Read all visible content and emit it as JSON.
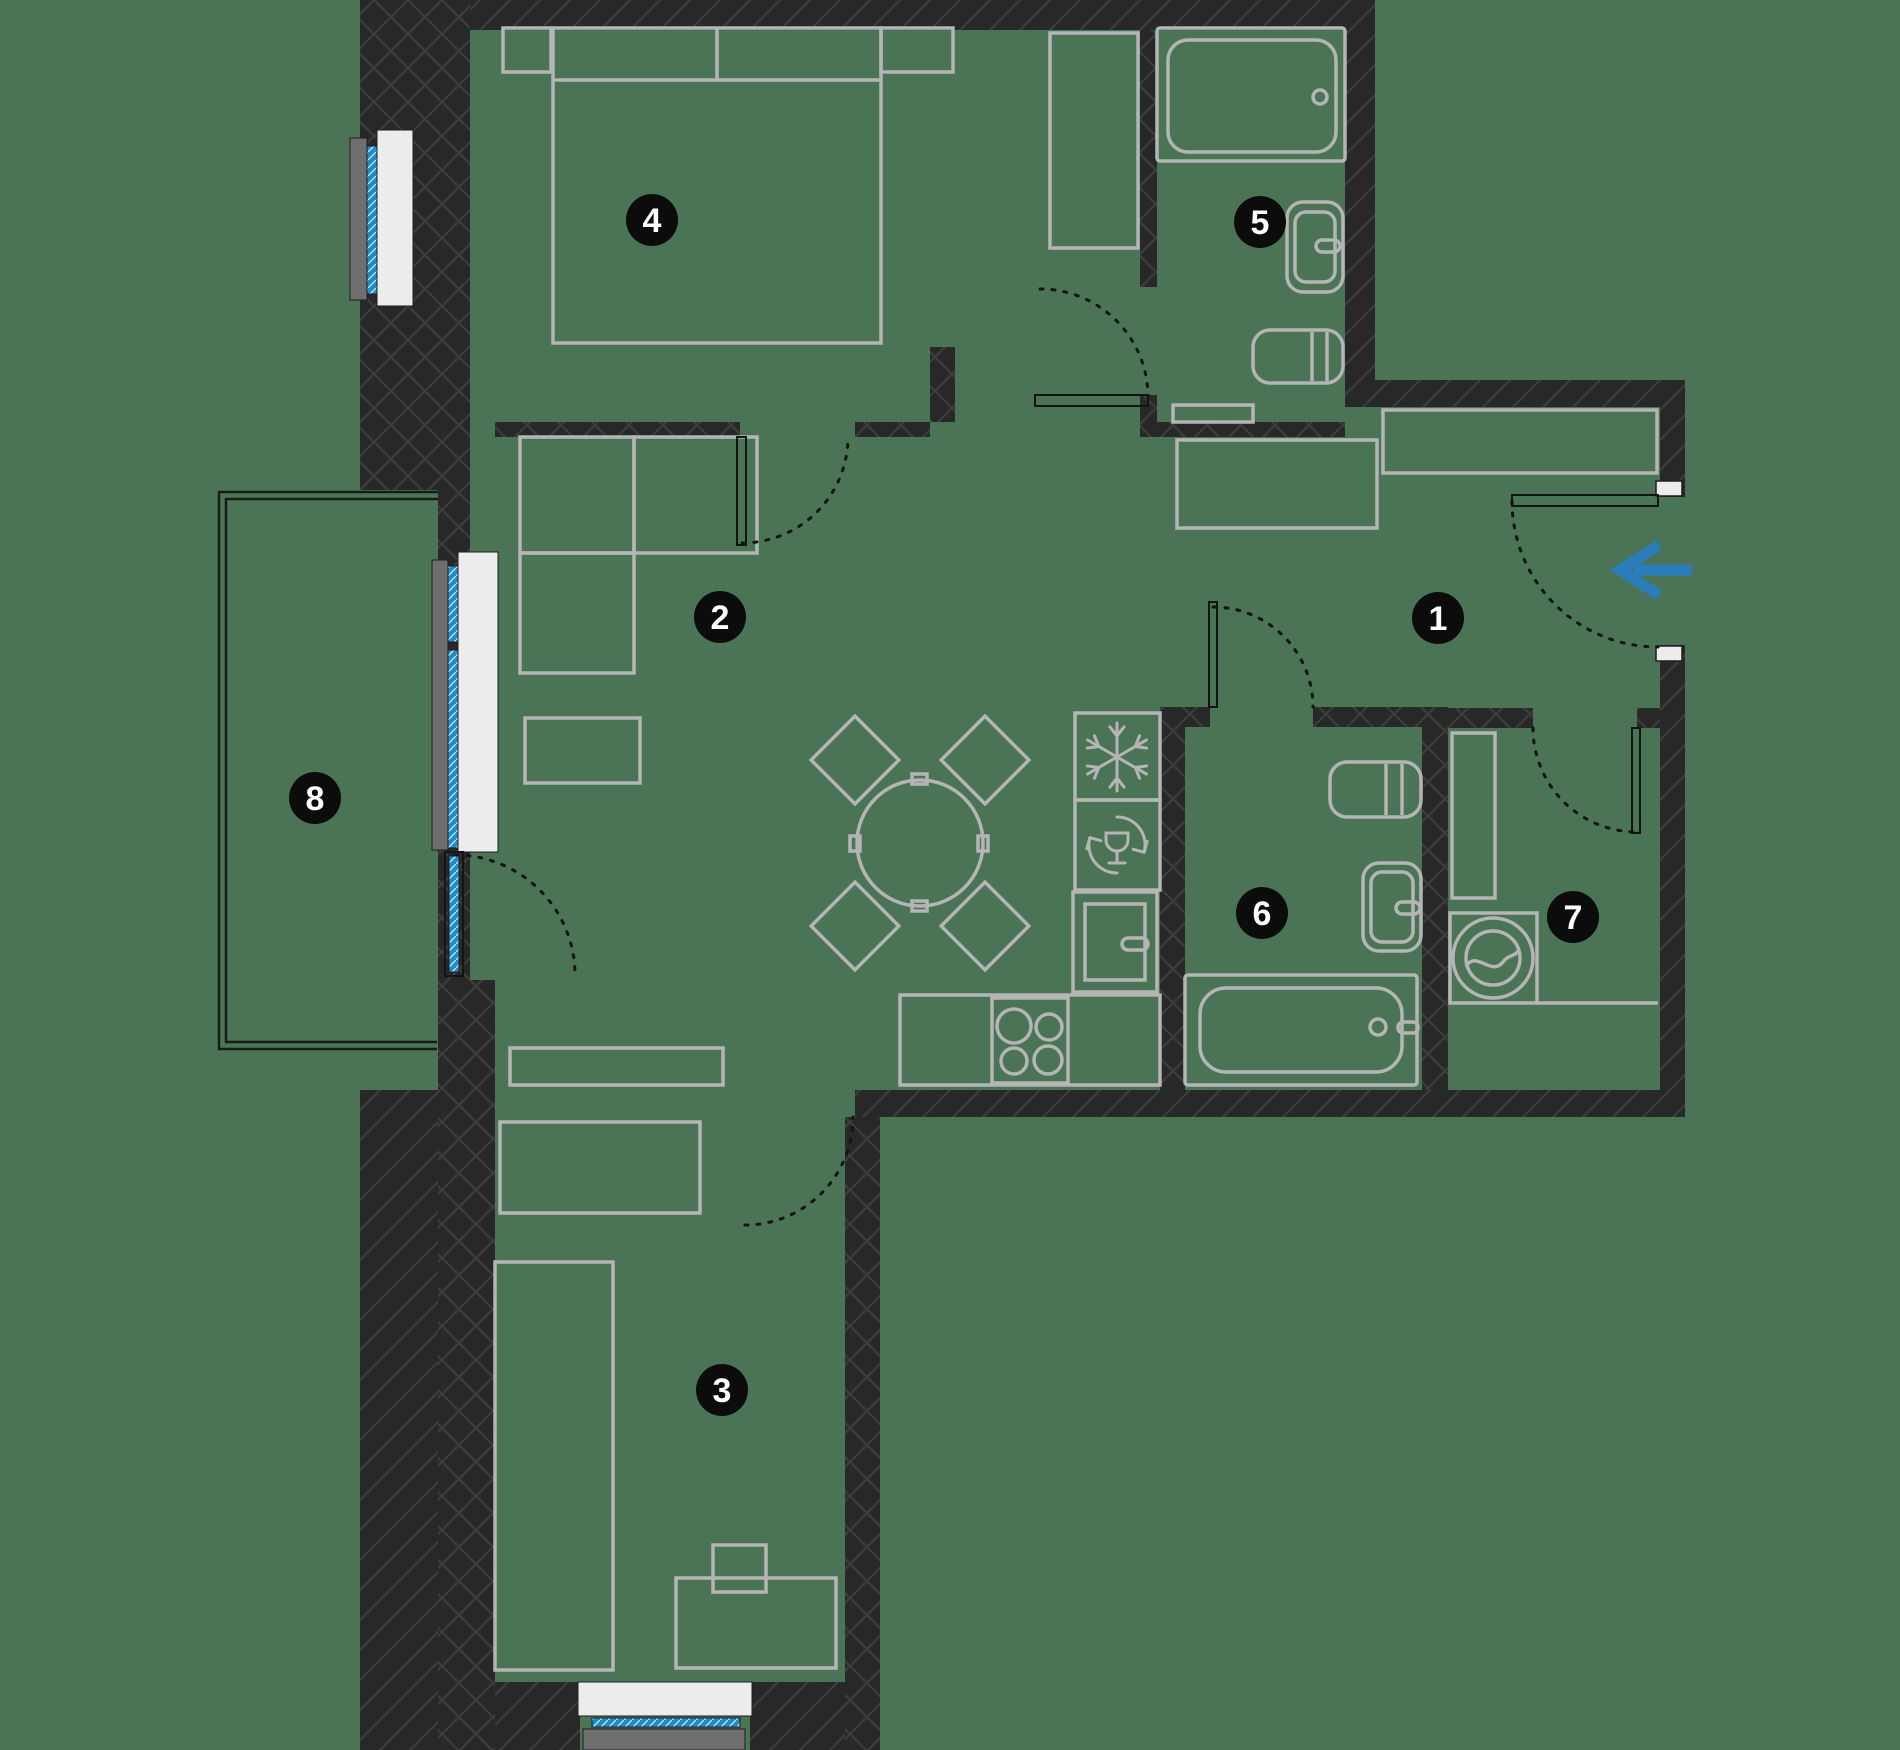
{
  "canvas": {
    "width": 1900,
    "height": 1750
  },
  "colors": {
    "background": "#4a7455",
    "wall": "#282828",
    "wall_hatch": "#3d3d3d",
    "furniture_stroke": "#b5b5b5",
    "sill_fill": "#ececec",
    "sill_stroke": "#1e1e1e",
    "ledge_fill": "#6f6f6f",
    "glass_fill": "#1e8ecb",
    "glass_hatch": "#c7e7f8",
    "door_line": "#141414",
    "marker_fill": "#0c0c0c",
    "marker_text": "#ffffff",
    "arrow": "#2b7cba",
    "rail": "#1a1a1a"
  },
  "markers": [
    {
      "label": "1",
      "x": 1438,
      "y": 618
    },
    {
      "label": "2",
      "x": 720,
      "y": 617
    },
    {
      "label": "3",
      "x": 722,
      "y": 1390
    },
    {
      "label": "4",
      "x": 652,
      "y": 220
    },
    {
      "label": "5",
      "x": 1260,
      "y": 222
    },
    {
      "label": "6",
      "x": 1262,
      "y": 913
    },
    {
      "label": "7",
      "x": 1573,
      "y": 917
    },
    {
      "label": "8",
      "x": 315,
      "y": 798
    }
  ],
  "entrance_arrow": {
    "shaft": [
      1692,
      570,
      1634,
      570
    ],
    "chevron": "1659,545 1620,570 1659,595",
    "width": 11
  },
  "walls_cross_hatch": [
    [
      360,
      0,
      110,
      490
    ],
    [
      438,
      490,
      32,
      562
    ],
    [
      438,
      980,
      57,
      770
    ],
    [
      845,
      1117,
      35,
      633
    ],
    [
      1140,
      30,
      17,
      257
    ],
    [
      1140,
      395,
      17,
      42
    ],
    [
      495,
      422,
      245,
      15
    ],
    [
      855,
      422,
      75,
      15
    ],
    [
      1140,
      422,
      205,
      15
    ],
    [
      930,
      347,
      25,
      75
    ],
    [
      1160,
      707,
      50,
      20
    ],
    [
      1313,
      707,
      135,
      20
    ],
    [
      1160,
      707,
      25,
      383
    ],
    [
      1422,
      727,
      26,
      363
    ],
    [
      1448,
      708,
      85,
      20
    ],
    [
      1637,
      708,
      23,
      20
    ]
  ],
  "walls_diag_hatch": [
    [
      360,
      0,
      1015,
      30
    ],
    [
      1345,
      0,
      30,
      407
    ],
    [
      1373,
      380,
      312,
      27
    ],
    [
      1660,
      407,
      25,
      90
    ],
    [
      1660,
      645,
      25,
      472
    ],
    [
      855,
      1090,
      830,
      27
    ],
    [
      420,
      1682,
      160,
      68
    ],
    [
      750,
      1682,
      130,
      68
    ],
    [
      360,
      1090,
      78,
      660
    ]
  ],
  "windows": {
    "ledges": [
      [
        350,
        138,
        17,
        162
      ],
      [
        432,
        560,
        16,
        290
      ],
      [
        583,
        1729,
        162,
        21
      ]
    ],
    "glass": [
      [
        367,
        146,
        10,
        148
      ],
      [
        448,
        566,
        10,
        76
      ],
      [
        448,
        650,
        10,
        198
      ],
      [
        592,
        1718,
        148,
        9
      ],
      [
        449,
        856,
        10,
        116
      ]
    ],
    "sills": [
      [
        377,
        130,
        36,
        176
      ],
      [
        458,
        552,
        40,
        300
      ],
      [
        578,
        1682,
        174,
        34
      ]
    ],
    "jamb_caps": [
      [
        1656,
        481,
        26,
        15
      ],
      [
        1656,
        646,
        26,
        15
      ]
    ]
  },
  "balcony_rails": [
    "M470,492 H219 V1049 H437",
    "M470,499 H226 V1042 H437"
  ],
  "door_leaves": [
    [
      "room4-door-leaf",
      737,
      437,
      9,
      108
    ],
    [
      "bath5-door-leaf",
      1035,
      395,
      113,
      11
    ],
    [
      "bath6-door-leaf",
      1209,
      602,
      8,
      105
    ],
    [
      "room7-door-leaf",
      1632,
      728,
      8,
      105
    ],
    [
      "entry-door-leaf",
      1512,
      495,
      146,
      11
    ],
    [
      "balcony-door-frame",
      445,
      852,
      18,
      124
    ]
  ],
  "door_arcs": [
    [
      "bath5-door-arc",
      "M1040,289 A108,108 0 0 1 1148,397"
    ],
    [
      "room4-door-arc",
      "M742,543 A106,106 0 0 0 848,437"
    ],
    [
      "balcony-door-arc",
      "M455,855 A120,120 0 0 1 575,975"
    ],
    [
      "room3-door-arc",
      "M745,1225 A108,108 0 0 0 853,1117"
    ],
    [
      "bath6-door-arc",
      "M1213,607 A100,100 0 0 1 1313,707"
    ],
    [
      "room7-door-arc",
      "M1533,728 A104,104 0 0 0 1637,832"
    ],
    [
      "entry-door-arc",
      "M1512,501 A146,146 0 0 0 1658,647"
    ]
  ],
  "furniture_rects": [
    [
      "bed-4",
      553,
      28,
      328,
      315,
      0
    ],
    [
      "nightstand-left",
      503,
      28,
      48,
      44,
      0
    ],
    [
      "nightstand-right",
      881,
      28,
      72,
      44,
      0
    ],
    [
      "wardrobe-4",
      1050,
      33,
      88,
      215,
      0
    ],
    [
      "sofa-seat-a",
      520,
      437,
      114,
      116,
      0
    ],
    [
      "sofa-seat-b",
      634,
      437,
      123,
      116,
      0
    ],
    [
      "sofa-seat-c",
      520,
      553,
      114,
      120,
      0
    ],
    [
      "coffee-table",
      525,
      718,
      115,
      65,
      0
    ],
    [
      "sideboard",
      510,
      1048,
      213,
      37,
      0
    ],
    [
      "hall-closet-a",
      1177,
      440,
      200,
      88,
      0
    ],
    [
      "hall-closet-b",
      1383,
      410,
      274,
      63,
      0
    ],
    [
      "wardrobe-3",
      500,
      1122,
      200,
      91,
      0
    ],
    [
      "bed-3",
      495,
      1262,
      118,
      408,
      0
    ],
    [
      "desk-3",
      676,
      1578,
      160,
      90,
      0
    ],
    [
      "chair-3",
      713,
      1545,
      53,
      47,
      0
    ],
    [
      "fridge",
      1075,
      713,
      85,
      87,
      0
    ],
    [
      "dishwasher",
      1075,
      800,
      85,
      90,
      0
    ],
    [
      "oven-unit-outer",
      1073,
      892,
      84,
      100,
      0
    ],
    [
      "oven-unit-inner",
      1085,
      904,
      60,
      76,
      0
    ],
    [
      "kitchen-counter",
      900,
      995,
      260,
      90,
      0
    ],
    [
      "hob-frame",
      992,
      998,
      76,
      85,
      0
    ],
    [
      "utility-cabinet",
      1452,
      733,
      43,
      165,
      0
    ],
    [
      "washing-machine",
      1450,
      913,
      87,
      90,
      0
    ],
    [
      "bath5-shelf",
      1173,
      405,
      80,
      17,
      0
    ],
    [
      "table-tab-n",
      912,
      774,
      15,
      10,
      0
    ],
    [
      "table-tab-s",
      912,
      901,
      15,
      10,
      0
    ],
    [
      "table-tab-w",
      850,
      836,
      10,
      15,
      0
    ],
    [
      "table-tab-e",
      978,
      836,
      10,
      15,
      0
    ],
    [
      "shower-tray-outer",
      1157,
      28,
      188,
      133,
      3
    ],
    [
      "shower-tray-inner",
      1168,
      40,
      168,
      112,
      20
    ],
    [
      "sink-5",
      1287,
      202,
      56,
      90,
      16
    ],
    [
      "sink-5-basin",
      1295,
      212,
      40,
      70,
      11
    ],
    [
      "tap-5",
      1316,
      240,
      24,
      12,
      6
    ],
    [
      "toilet-5",
      1253,
      330,
      90,
      53,
      17
    ],
    [
      "toilet-6",
      1330,
      762,
      91,
      55,
      17
    ],
    [
      "sink-6",
      1363,
      863,
      58,
      88,
      16
    ],
    [
      "sink-6-basin",
      1371,
      872,
      42,
      70,
      11
    ],
    [
      "tap-6",
      1396,
      902,
      24,
      12,
      6
    ],
    [
      "bathtub-outer",
      1185,
      975,
      232,
      110,
      3
    ],
    [
      "bathtub-inner",
      1200,
      988,
      202,
      84,
      26
    ],
    [
      "bathtub-tap",
      1398,
      1022,
      20,
      11,
      5
    ],
    [
      "oven-handle",
      1122,
      938,
      26,
      12,
      6
    ]
  ],
  "furniture_circles": [
    [
      "dining-table",
      920,
      843,
      63
    ],
    [
      "shower-drain",
      1320,
      97,
      7
    ],
    [
      "bathtub-faucet",
      1378,
      1027,
      8
    ],
    [
      "washer-drum-outer",
      1493,
      958,
      40
    ],
    [
      "washer-drum-inner",
      1493,
      958,
      27
    ],
    [
      "hob-burner-1",
      1014,
      1026,
      17
    ],
    [
      "hob-burner-2",
      1049,
      1027,
      13
    ],
    [
      "hob-burner-3",
      1014,
      1061,
      13
    ],
    [
      "hob-burner-4",
      1048,
      1060,
      14
    ]
  ],
  "furniture_lines": [
    [
      "bed4-pillow-line",
      553,
      80,
      881,
      80
    ],
    [
      "bed4-pillow-divider",
      717,
      28,
      717,
      80
    ],
    [
      "toilet5-cistern-1",
      1312,
      332,
      1312,
      381
    ],
    [
      "toilet5-cistern-2",
      1327,
      332,
      1327,
      381
    ],
    [
      "toilet6-cistern-1",
      1386,
      764,
      1386,
      815
    ],
    [
      "toilet6-cistern-2",
      1402,
      764,
      1402,
      815
    ],
    [
      "utility-counter-line",
      1537,
      1003,
      1658,
      1003
    ]
  ],
  "furniture_paths": [
    [
      "washer-wave",
      "M1466,966 C1477,950 1491,977 1503,962 C1509,954 1515,957 1519,950"
    ]
  ],
  "chairs": [
    [
      "dining-chair-nw",
      855,
      760,
      62,
      45
    ],
    [
      "dining-chair-ne",
      985,
      760,
      62,
      45
    ],
    [
      "dining-chair-sw",
      855,
      926,
      62,
      45
    ],
    [
      "dining-chair-se",
      985,
      926,
      62,
      45
    ]
  ],
  "icons": [
    {
      "type": "snowflake",
      "name": "freezer-icon",
      "x": 1117,
      "y": 757,
      "r": 34
    },
    {
      "type": "dishwasher",
      "name": "dishwasher-icon",
      "x": 1117,
      "y": 845,
      "r": 28
    }
  ]
}
